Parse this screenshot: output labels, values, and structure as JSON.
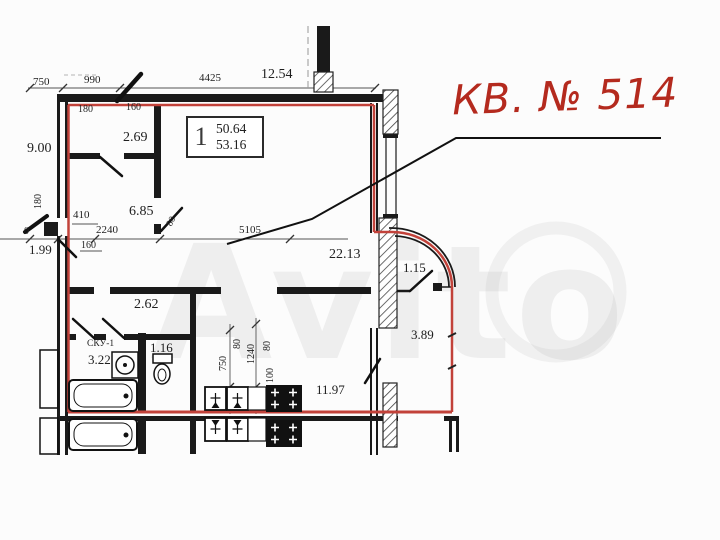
{
  "watermark": "Avito",
  "title": {
    "apartment_label": "КВ. № 514"
  },
  "unit_box": {
    "number": "1",
    "area_upper": "50.64",
    "area_lower": "53.16"
  },
  "colors": {
    "plan_red": "#c2423a",
    "title_red": "#b42a1e",
    "wall_black": "#1a1a1a"
  },
  "labels": {
    "dim_top_750": "750",
    "dim_top_990": "990",
    "dim_top_4425": "4425",
    "dim_top_12_54": "12.54",
    "dim_lintel_180": "180",
    "dim_lintel_160": "160",
    "room_2_69": "2.69",
    "dim_left_9_00": "9.00",
    "dim_left_180_vert": "180",
    "dim_410": "410",
    "dim_2240": "2240",
    "dim_zero": "0",
    "dim_1_99": "1.99",
    "dim_160": "160",
    "room_6_85": "6.85",
    "dim_80_door": "80",
    "dim_5105": "5105",
    "room_22_13": "22.13",
    "room_1_15": "1.15",
    "room_2_62": "2.62",
    "room_sku": "СКУ-1",
    "room_3_22": "3.22",
    "room_1_16": "1.16",
    "room_3_89": "3.89",
    "room_11_97": "11.97",
    "dim_k_750": "750",
    "dim_k_80_a": "80",
    "dim_k_1240": "1240",
    "dim_k_80_b": "80",
    "dim_k_100": "100"
  }
}
